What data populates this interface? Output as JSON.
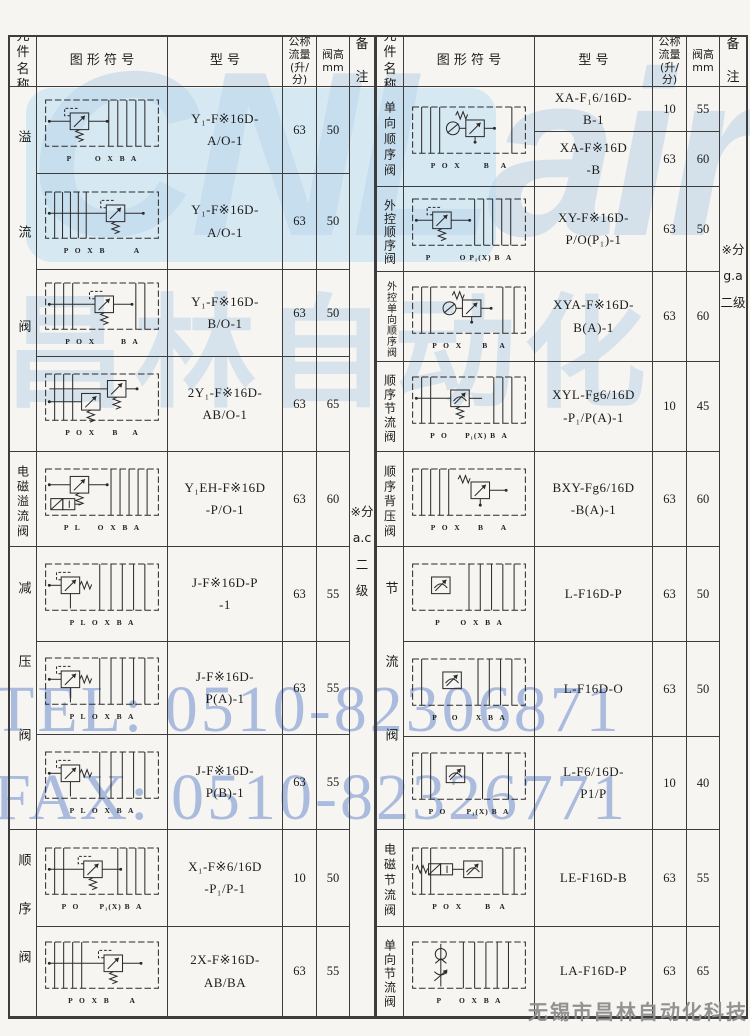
{
  "page": {
    "watermark_logo": "CNLair",
    "watermark_cn": "昌林自动化",
    "watermark_tel": "TEL: 0510-82306871",
    "watermark_fax": "FAX: 0510-82326771",
    "company": "无锡市昌林自动化科技",
    "colors": {
      "watermark_blue": "#7894d0",
      "logo_blue": "#b2cee6",
      "border": "#3d3d3d",
      "ink": "#1c1c1c"
    }
  },
  "header": {
    "name": "元\n件\n名\n称",
    "symbol": "图 形 符 号",
    "model": "型        号",
    "flow": "公称\n流量\n(升/\n分)",
    "height": "阀高\nmm",
    "note": "备\n\n注"
  },
  "left": {
    "note": "※分\na.c\n二级",
    "groups": [
      {
        "name": "溢流阀"
      },
      {
        "name": "电磁溢流阀"
      },
      {
        "name": "减压阀"
      },
      {
        "name": "顺序阀"
      }
    ],
    "rows": [
      {
        "model": "Y₁-F※16D-\nA/O-1",
        "flow": "63",
        "height": "50",
        "symbol": "relief-valve-symbol",
        "ports": "P        O  X  B  A"
      },
      {
        "model": "Y₁-F※16D-\nA/O-1",
        "flow": "63",
        "height": "50",
        "symbol": "relief-valve-symbol",
        "ports": "P  O  X  B          A"
      },
      {
        "model": "Y₁-F※16D-\nB/O-1",
        "flow": "63",
        "height": "50",
        "symbol": "relief-valve-symbol",
        "ports": "P  O  X         B  A"
      },
      {
        "model": "2Y₁-F※16D-\nAB/O-1",
        "flow": "63",
        "height": "65",
        "symbol": "double-relief-valve-symbol",
        "ports": "P  O  X      B     A"
      },
      {
        "model": "Y₁EH-F※16D\n-P/O-1",
        "flow": "63",
        "height": "60",
        "symbol": "solenoid-relief-valve-symbol",
        "ports": "P  L      O  X  B  A"
      },
      {
        "model": "J-F※16D-P\n-1",
        "flow": "63",
        "height": "55",
        "symbol": "reducing-valve-symbol",
        "ports": "P  L  O  X  B  A"
      },
      {
        "model": "J-F※16D-\nP(A)-1",
        "flow": "63",
        "height": "55",
        "symbol": "reducing-valve-symbol",
        "ports": "P  L  O  X  B  A"
      },
      {
        "model": "J-F※16D-\nP(B)-1",
        "flow": "63",
        "height": "55",
        "symbol": "reducing-valve-symbol",
        "ports": "P  L  O  X  B  A"
      },
      {
        "model": "X₁-F※6/16D\n-P₁/P-1",
        "flow": "10",
        "height": "50",
        "symbol": "sequence-valve-symbol",
        "ports": "P  O       P₁(X) B  A"
      },
      {
        "model": "2X-F※16D-\nAB/BA",
        "flow": "63",
        "height": "55",
        "symbol": "relief-valve-symbol",
        "ports": "P  O  X  B       A"
      }
    ]
  },
  "right": {
    "note": "※分\ng.a\n二级",
    "groups": [
      {
        "name": "单向顺序阀"
      },
      {
        "name": "外控顺序阀"
      },
      {
        "name": "外控单向顺序阀"
      },
      {
        "name": "顺序节流阀"
      },
      {
        "name": "顺序背压阀"
      },
      {
        "name": "节流阀"
      },
      {
        "name": "电磁节流阀"
      },
      {
        "name": "单向节流阀"
      }
    ],
    "symbols": [
      {
        "symbol": "check-sequence-valve-symbol",
        "ports": "P  O  X        B    A"
      },
      {
        "symbol": "sequence-valve-symbol",
        "ports": "P          O P₁(X) B  A"
      },
      {
        "symbol": "check-sequence-valve-symbol",
        "ports": "P  O  X       B    A"
      },
      {
        "symbol": "sequence-throttle-valve-symbol",
        "ports": "P  O      P₁(X) B  A"
      },
      {
        "symbol": "backpressure-valve-symbol",
        "ports": "P  O  X      B      A"
      },
      {
        "symbol": "throttle-valve-symbol",
        "ports": "P       O  X  B  A"
      },
      {
        "symbol": "throttle-valve-symbol",
        "ports": "P     O      X  B  A"
      },
      {
        "symbol": "throttle-valve-symbol",
        "ports": "P  O       P₁(X) B  A"
      },
      {
        "symbol": "solenoid-throttle-valve-symbol",
        "ports": "P  O  X        B   A"
      },
      {
        "symbol": "check-throttle-valve-symbol",
        "ports": "P      O  X  B  A"
      }
    ],
    "rows": [
      {
        "model": "XA-F₁6/16D-\nB-1",
        "flow": "10",
        "height": "55"
      },
      {
        "model": "XA-F※16D\n-B",
        "flow": "63",
        "height": "60"
      },
      {
        "model": "XY-F※16D-\nP/O(P₁)-1",
        "flow": "63",
        "height": "50"
      },
      {
        "model": "XYA-F※16D-\nB(A)-1",
        "flow": "63",
        "height": "60"
      },
      {
        "model": "XYL-Fg6/16D\n-P₁/P(A)-1",
        "flow": "10",
        "height": "45"
      },
      {
        "model": "BXY-Fg6/16D\n-B(A)-1",
        "flow": "63",
        "height": "60"
      },
      {
        "model": "L-F16D-P",
        "flow": "63",
        "height": "50"
      },
      {
        "model": "L-F16D-O",
        "flow": "63",
        "height": "50"
      },
      {
        "model": "L-F6/16D-\nP1/P",
        "flow": "10",
        "height": "40"
      },
      {
        "model": "LE-F16D-B",
        "flow": "63",
        "height": "55"
      },
      {
        "model": "LA-F16D-P",
        "flow": "63",
        "height": "65"
      }
    ]
  }
}
